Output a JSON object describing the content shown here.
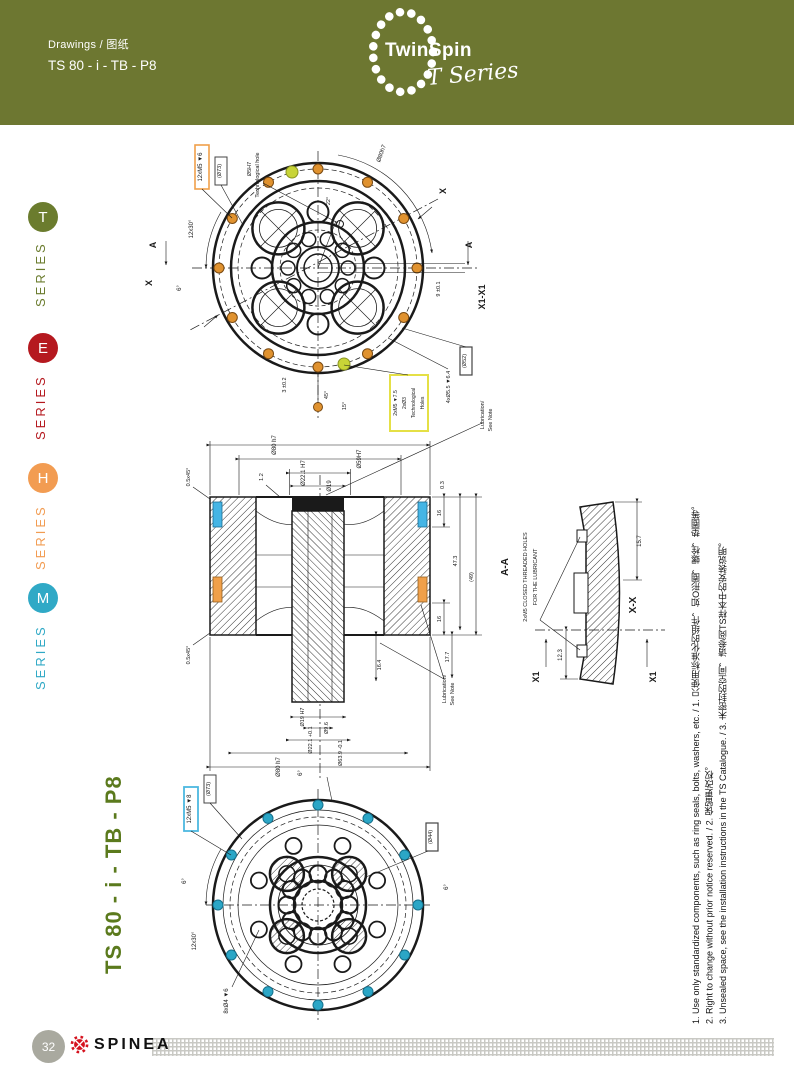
{
  "header": {
    "breadcrumb": "Drawings / 图纸",
    "title": "TS 80 - i - TB - P8",
    "logo": {
      "brand": "TwinSpin",
      "series": "T Series"
    }
  },
  "sidebar": {
    "items": [
      {
        "letter": "T",
        "label": "SERIES",
        "color": "#6b7c2e"
      },
      {
        "letter": "E",
        "label": "SERIES",
        "color": "#b5191f"
      },
      {
        "letter": "H",
        "label": "SERIES",
        "color": "#f29c52"
      },
      {
        "letter": "M",
        "label": "SERIES",
        "color": "#30a9c6"
      }
    ]
  },
  "drawing": {
    "vertical_title": "TS 80 - i - TB - P8",
    "top_view": {
      "callout_bolts": "12xM5 ▼6",
      "callout_d73": "(Ø73)",
      "tech_hole_1": "Ø5H7",
      "tech_hole_2": "Technological hole",
      "arc_dim": "Ø80h7",
      "angle_12x30": "12x30°",
      "angle_6": "6°",
      "angle_22": "22°",
      "dim_9": "9 ±0.1",
      "section_label": "X1-X1",
      "callout_d52": "(Ø52)",
      "dim_55": "4xØ5.5 ▼6.4",
      "yellow_box_1": "2xM5 ▼7.5",
      "yellow_box_2": "2xØ3",
      "yellow_box_3": "Technological",
      "yellow_box_4": "Holes",
      "note_1": "Lubrication/",
      "note_2": "See Note",
      "angle_15": "15°",
      "angle_45": "45°",
      "dim_3": "3 ±0.2",
      "marker_a": "A",
      "marker_x": "X"
    },
    "section_view": {
      "dim_top_1": "Ø80 h7",
      "dim_top_2": "Ø59H7",
      "dim_top_3": "Ø22.1 H7",
      "dim_top_4": "Ø19",
      "chamfer": "0.5x45°",
      "dim_12": "1.2",
      "dim_03": "0.3",
      "dim_16a": "16",
      "dim_473": "47.3",
      "dim_49": "(49)",
      "dim_16b": "16",
      "dim_177": "17.7",
      "dim_164": "16.4",
      "dim_bot_1": "Ø19 H7",
      "dim_bot_2": "Ø9.6",
      "dim_bot_3": "Ø22.1 +0.1",
      "dim_bot_4": "Ø63.9 -0.1",
      "dim_bot_5": "Ø80 h7",
      "section_label": "A-A",
      "note_1": "Lubrication/",
      "note_2": "See Note"
    },
    "side_section": {
      "note_line1": "2xM5 CLOSED THREADED HOLES",
      "note_line2": "FOR THE LUBRICANT",
      "dim_157": "15.7",
      "dim_123": "12.3",
      "section_label": "X-X",
      "marker_x1": "X1"
    },
    "bottom_view": {
      "callout_bolts": "12xM5 ▼8",
      "callout_d73": "(Ø73)",
      "callout_d44": "(Ø44)",
      "angle_6": "6°",
      "angle_12x30": "12x30°",
      "dim_8x": "8xØ4 ▼6"
    }
  },
  "notes": {
    "line1": "1. Use only standardized components, such as ring seals, bolts, washers, etc. / 1. 只使用标准化的组件，如O形圈，螺栓，垫圈等。",
    "line2": "2. Right to change without prior notice reserved. / 2. 保留更改权。",
    "line3": "3. Unsealed space, see the installation instructions in the TS Catalogue. / 3. 未密封的空间，请参阅TS样本中的安装说明。"
  },
  "footer": {
    "page_number": "32",
    "brand": "SPINEA"
  },
  "colors": {
    "header_bg": "#6d7731",
    "accent_orange": "#e0922f",
    "accent_yellow": "#c8d437",
    "accent_cyan": "#2ba6c6",
    "accent_blue": "#45b5e5",
    "title_green": "#5b7a1d"
  }
}
